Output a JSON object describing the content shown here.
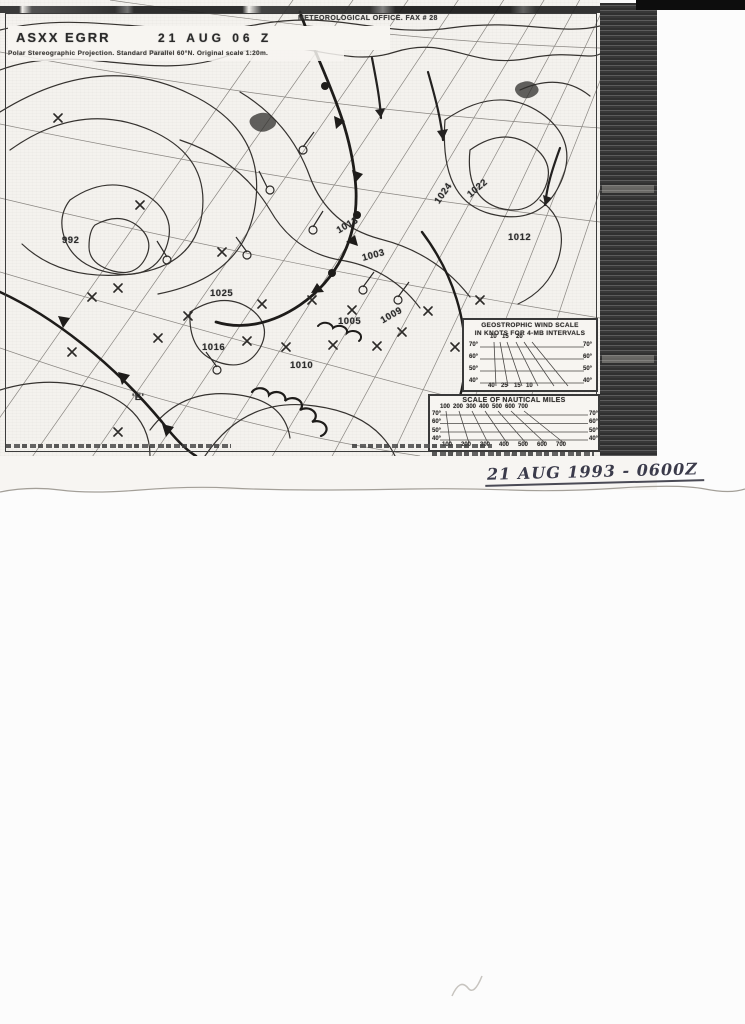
{
  "colors": {
    "page_bg": "#fcfcfc",
    "paper": "#f4f2ee",
    "ink": "#2e2c2a",
    "fax_band": "#474747",
    "scan_edge_bar": "#0d0d0d",
    "handwriting": "#3b3b4b"
  },
  "scan": {
    "header": {
      "bulletin_id": "ASXX EGRR",
      "issue_time": "21 AUG 06 Z",
      "office_line": "METEOROLOGICAL OFFICE. FAX # 28",
      "projection_note": "Polar Stereographic Projection. Standard Parallel 60°N. Original scale 1:20m."
    },
    "map": {
      "pressure_labels": [
        {
          "text": "1024",
          "x": 432,
          "y": 188,
          "rot": -55
        },
        {
          "text": "1022",
          "x": 466,
          "y": 183,
          "rot": -40
        },
        {
          "text": "1013",
          "x": 336,
          "y": 220,
          "rot": -30
        },
        {
          "text": "1003",
          "x": 362,
          "y": 250,
          "rot": -15
        },
        {
          "text": "1025",
          "x": 210,
          "y": 288,
          "rot": 0
        },
        {
          "text": "1016",
          "x": 202,
          "y": 342,
          "rot": 0
        },
        {
          "text": "1010",
          "x": 290,
          "y": 360,
          "rot": 0
        },
        {
          "text": "1005",
          "x": 338,
          "y": 316,
          "rot": 0
        },
        {
          "text": "1009",
          "x": 380,
          "y": 310,
          "rot": -30
        },
        {
          "text": "1012",
          "x": 508,
          "y": 232,
          "rot": 0
        },
        {
          "text": "992",
          "x": 62,
          "y": 235,
          "rot": 0
        },
        {
          "text": "'E'",
          "x": 132,
          "y": 392,
          "rot": 0
        }
      ]
    },
    "wind_scale": {
      "title_line1": "GEOSTROPHIC WIND SCALE",
      "title_line2": "IN KNOTS FOR 4-MB INTERVALS",
      "numbers": [
        {
          "text": "10",
          "x": 26,
          "y": 14
        },
        {
          "text": "15",
          "x": 38,
          "y": 14
        },
        {
          "text": "20",
          "x": 52,
          "y": 14
        },
        {
          "text": "70°",
          "x": 5,
          "y": 22
        },
        {
          "text": "60°",
          "x": 5,
          "y": 34
        },
        {
          "text": "50°",
          "x": 5,
          "y": 46
        },
        {
          "text": "40°",
          "x": 5,
          "y": 58
        },
        {
          "text": "70°",
          "x": 119,
          "y": 22
        },
        {
          "text": "60°",
          "x": 119,
          "y": 34
        },
        {
          "text": "50°",
          "x": 119,
          "y": 46
        },
        {
          "text": "40°",
          "x": 119,
          "y": 58
        },
        {
          "text": "40",
          "x": 24,
          "y": 63
        },
        {
          "text": "25",
          "x": 37,
          "y": 63
        },
        {
          "text": "15",
          "x": 50,
          "y": 63
        },
        {
          "text": "10",
          "x": 62,
          "y": 63
        }
      ]
    },
    "miles_scale": {
      "title": "SCALE OF NAUTICAL MILES",
      "numbers": [
        {
          "text": "100",
          "x": 10,
          "y": 8
        },
        {
          "text": "200",
          "x": 23,
          "y": 8
        },
        {
          "text": "300",
          "x": 36,
          "y": 8
        },
        {
          "text": "400",
          "x": 49,
          "y": 8
        },
        {
          "text": "500",
          "x": 62,
          "y": 8
        },
        {
          "text": "600",
          "x": 75,
          "y": 8
        },
        {
          "text": "700",
          "x": 88,
          "y": 8
        },
        {
          "text": "70°",
          "x": 2,
          "y": 15
        },
        {
          "text": "60°",
          "x": 2,
          "y": 23
        },
        {
          "text": "50°",
          "x": 2,
          "y": 32
        },
        {
          "text": "40°",
          "x": 2,
          "y": 40
        },
        {
          "text": "70°",
          "x": 159,
          "y": 15
        },
        {
          "text": "60°",
          "x": 159,
          "y": 23
        },
        {
          "text": "50°",
          "x": 159,
          "y": 32
        },
        {
          "text": "40°",
          "x": 159,
          "y": 40
        },
        {
          "text": "100",
          "x": 12,
          "y": 46
        },
        {
          "text": "200",
          "x": 31,
          "y": 46
        },
        {
          "text": "300",
          "x": 50,
          "y": 46
        },
        {
          "text": "400",
          "x": 69,
          "y": 46
        },
        {
          "text": "500",
          "x": 88,
          "y": 46
        },
        {
          "text": "600",
          "x": 107,
          "y": 46
        },
        {
          "text": "700",
          "x": 126,
          "y": 46
        }
      ]
    },
    "handwritten_note": "21 AUG 1993 - 0600Z"
  }
}
